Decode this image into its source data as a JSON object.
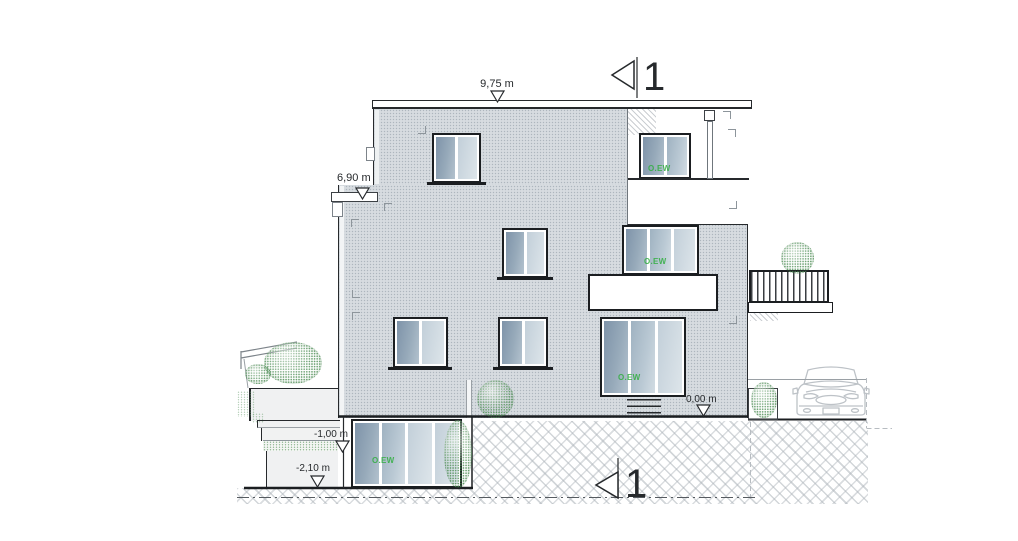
{
  "section_markers": {
    "top": "1",
    "bottom": "1"
  },
  "dimensions": {
    "roof": "9,75 m",
    "upper_setback": "6,90 m",
    "ground": "0,00 m",
    "terrace_mid": "-1,00 m",
    "terrace_low": "-2,10 m"
  },
  "window_tags": {
    "attic": "O.EW",
    "middle": "O.EW",
    "ground": "O.EW",
    "basement": "O.EW"
  },
  "colors": {
    "facade": "#d7dce0",
    "glass_dark": "#7e93a9",
    "glass_light": "#dde5ea",
    "line": "#1b1e21",
    "tag_green": "#2fae3e",
    "bush_green": "#488a50",
    "hatch_gray": "#b0b6bc"
  },
  "symbols": [
    "section-flag-icon",
    "level-triangle-icon",
    "bush-icon",
    "car-icon"
  ]
}
